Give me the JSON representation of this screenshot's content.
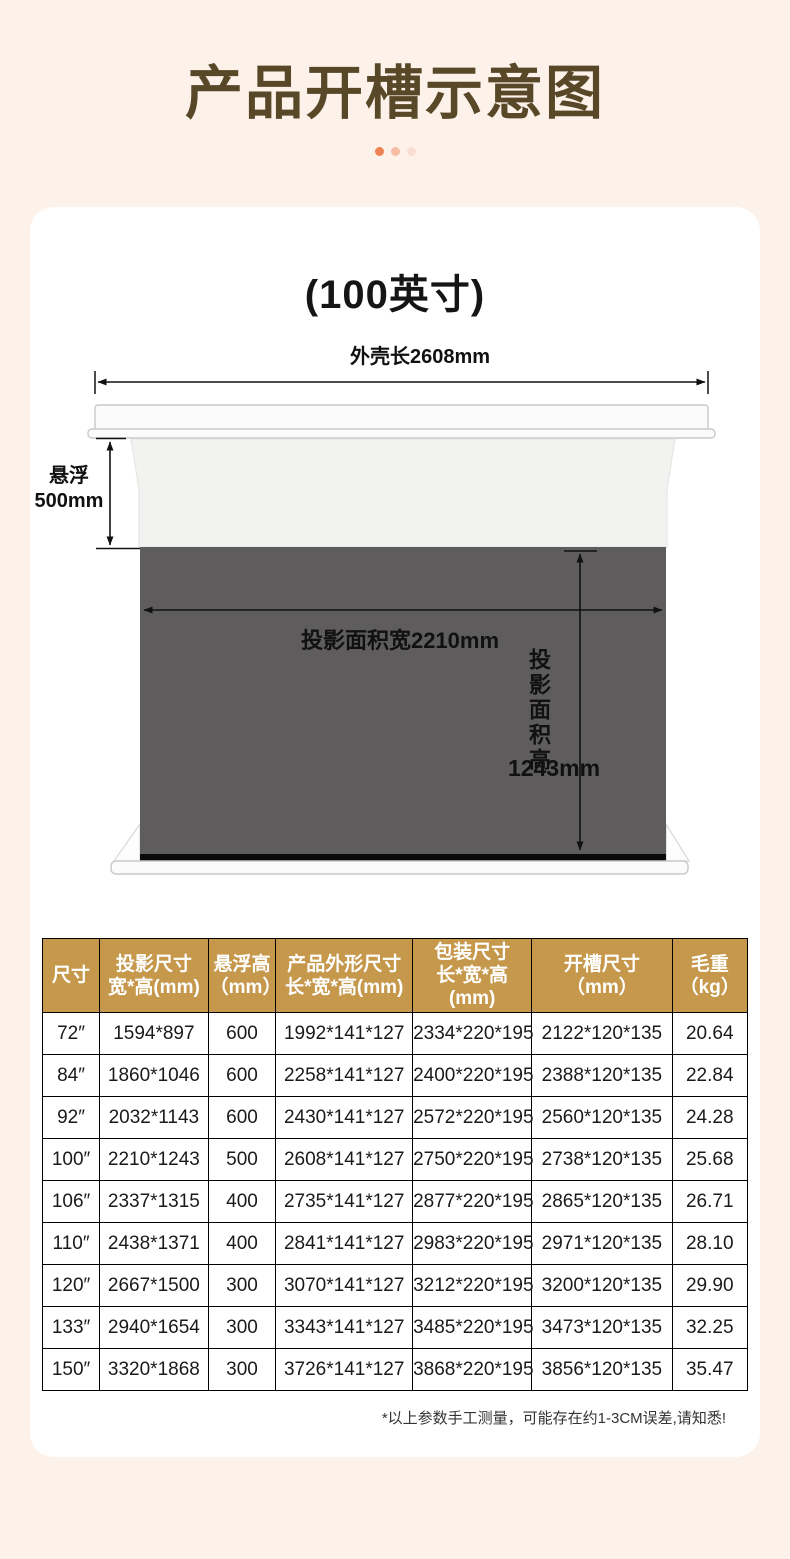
{
  "page": {
    "title": "产品开槽示意图",
    "bg_color": "#FCF2E9",
    "title_color": "#584828",
    "dots": [
      "#F08356",
      "#F6BCA4",
      "#FBDED2"
    ]
  },
  "diagram": {
    "subtitle": "(100英寸)",
    "labels": {
      "shell_length": "外壳长2608mm",
      "suspend_line1": "悬浮",
      "suspend_line2": "500mm",
      "projection_width": "投影面积宽2210mm",
      "projection_height": "投影面积高",
      "projection_height_value": "1243mm"
    },
    "colors": {
      "projection_area": "#5E5C5C",
      "bottom_bar": "#0A0A0A",
      "housing": "#FBFBFB"
    }
  },
  "table": {
    "header_bg": "#C6984C",
    "columns": [
      {
        "label": "尺寸",
        "sub": ""
      },
      {
        "label": "投影尺寸",
        "sub": "宽*高(mm)"
      },
      {
        "label": "悬浮高",
        "sub": "（mm）"
      },
      {
        "label": "产品外形尺寸",
        "sub": "长*宽*高(mm)"
      },
      {
        "label": "包装尺寸",
        "sub": "长*宽*高(mm)"
      },
      {
        "label": "开槽尺寸",
        "sub": "（mm）"
      },
      {
        "label": "毛重",
        "sub": "（kg）"
      }
    ],
    "rows": [
      [
        "72″",
        "1594*897",
        "600",
        "1992*141*127",
        "2334*220*195",
        "2122*120*135",
        "20.64"
      ],
      [
        "84″",
        "1860*1046",
        "600",
        "2258*141*127",
        "2400*220*195",
        "2388*120*135",
        "22.84"
      ],
      [
        "92″",
        "2032*1143",
        "600",
        "2430*141*127",
        "2572*220*195",
        "2560*120*135",
        "24.28"
      ],
      [
        "100″",
        "2210*1243",
        "500",
        "2608*141*127",
        "2750*220*195",
        "2738*120*135",
        "25.68"
      ],
      [
        "106″",
        "2337*1315",
        "400",
        "2735*141*127",
        "2877*220*195",
        "2865*120*135",
        "26.71"
      ],
      [
        "110″",
        "2438*1371",
        "400",
        "2841*141*127",
        "2983*220*195",
        "2971*120*135",
        "28.10"
      ],
      [
        "120″",
        "2667*1500",
        "300",
        "3070*141*127",
        "3212*220*195",
        "3200*120*135",
        "29.90"
      ],
      [
        "133″",
        "2940*1654",
        "300",
        "3343*141*127",
        "3485*220*195",
        "3473*120*135",
        "32.25"
      ],
      [
        "150″",
        "3320*1868",
        "300",
        "3726*141*127",
        "3868*220*195",
        "3856*120*135",
        "35.47"
      ]
    ],
    "footnote": "*以上参数手工测量，可能存在约1-3CM误差,请知悉!"
  }
}
